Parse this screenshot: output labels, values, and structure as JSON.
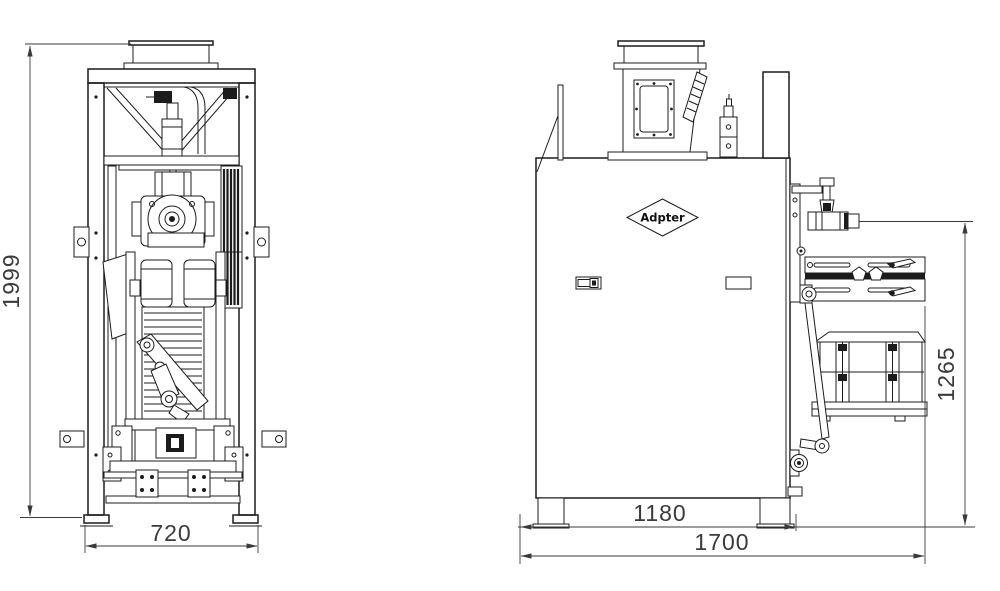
{
  "drawing": {
    "type": "technical-drawing",
    "views": {
      "front": {
        "dimensions": {
          "overall_height": "1999",
          "base_width": "720"
        }
      },
      "side": {
        "label": "Adpter",
        "dimensions": {
          "leg_span": "1180",
          "overall_depth": "1700",
          "spout_height": "1265"
        }
      }
    },
    "colors": {
      "background": "#ffffff",
      "line": "#1c1c1c",
      "dimension": "#3a3a3a"
    }
  }
}
